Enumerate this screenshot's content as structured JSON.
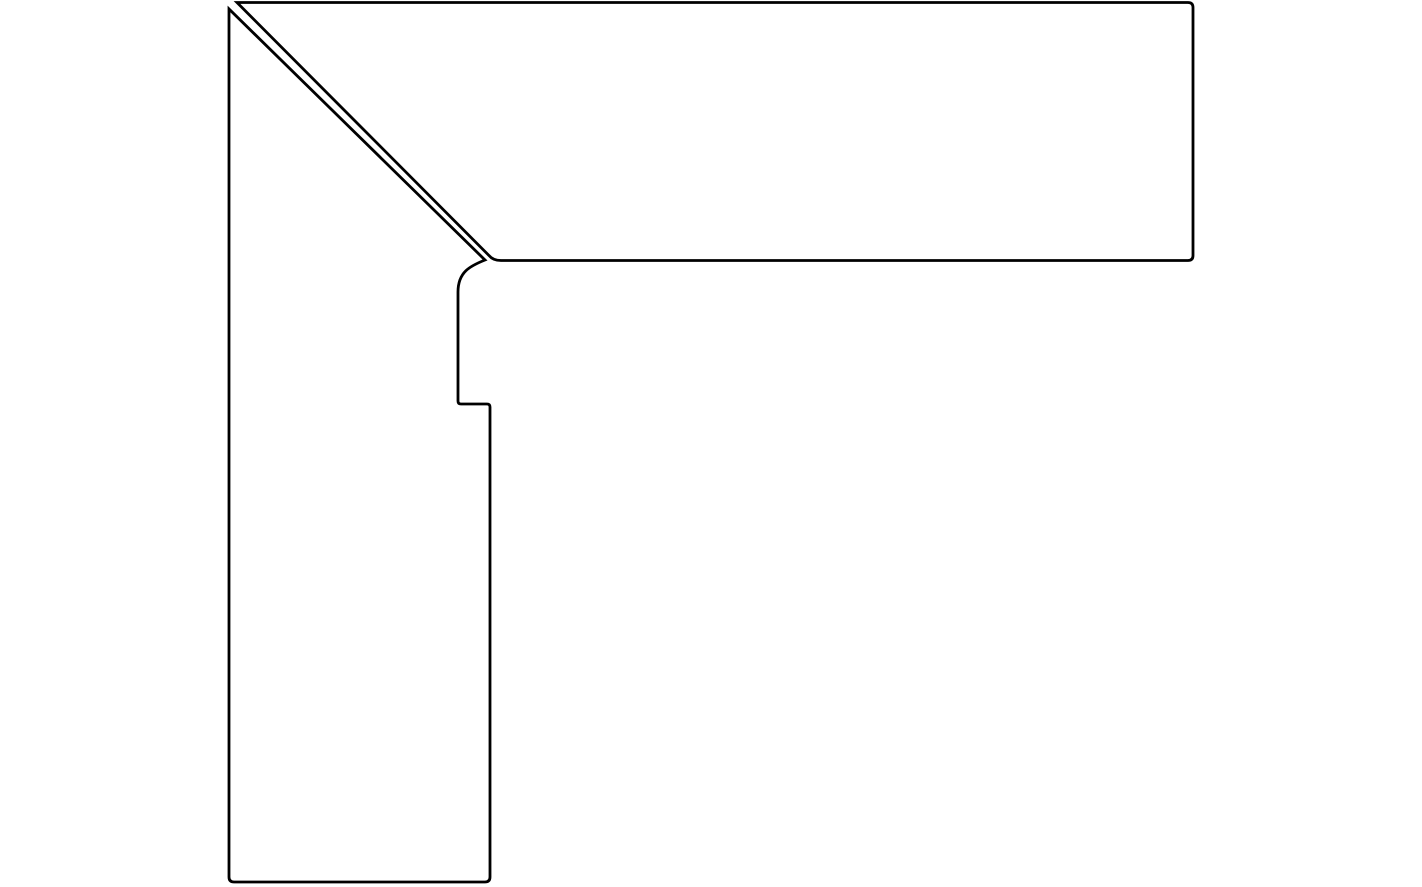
{
  "canvas": {
    "width": 887,
    "height": 887,
    "viewbox": "0 0 1422 887",
    "background_color": "#ffffff"
  },
  "drawing": {
    "description": "Outline line drawing of two skirting-board profile pieces joined at a 45-degree mitre corner: a vertical piece on the left and a horizontal piece across the top, separated by a thin diagonal seam",
    "stroke_color": "#000000",
    "stroke_width": "2.8",
    "fill": "none",
    "left_piece": {
      "label": "vertical profile piece",
      "path": "M 485 260 C 470 266 458 272 458 292 L 458 401 Q 458 404 461 404 L 487 404 Q 490 404 490 407 L 490 877 Q 490 882 485 882 L 234 882 Q 229 882 229 877 L 229 9 Z"
    },
    "top_piece": {
      "label": "horizontal profile piece",
      "path": "M 237 2.5 L 1188 2.5 Q 1193 2.5 1193 7.5 L 1193 255.5 Q 1193 260.5 1188 260.5 L 501 260.5 Q 493 260.5 489 255.5 Z"
    }
  }
}
